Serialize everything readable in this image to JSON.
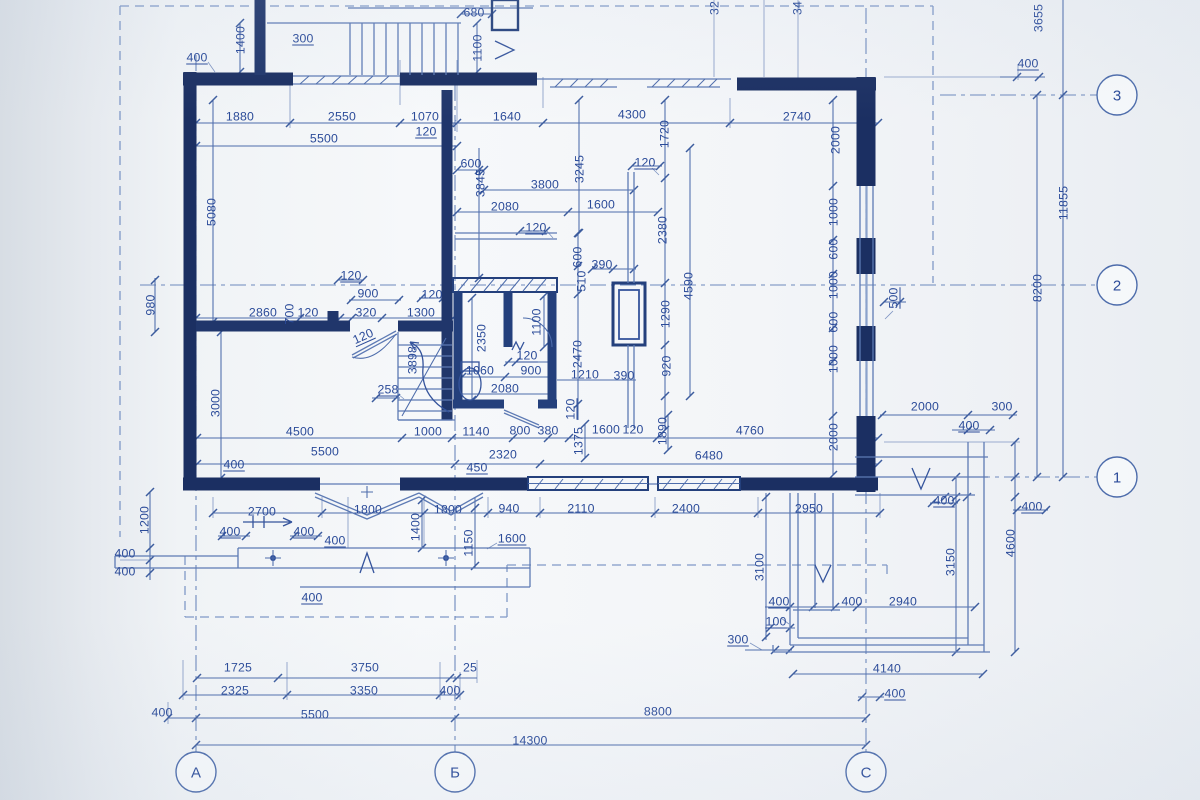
{
  "drawing": {
    "type": "architectural floor plan blueprint",
    "units": "mm"
  },
  "colors": {
    "paper": "#f0f3f6",
    "line_thin": "#4d6cab",
    "wall": "#1b2f62",
    "text": "#2b4b99",
    "dashed": "#8099c7"
  },
  "axis_circles": {
    "radius": 20,
    "bottom": [
      {
        "label": "А",
        "x": 196,
        "y": 772
      },
      {
        "label": "Б",
        "x": 455,
        "y": 772
      },
      {
        "label": "С",
        "x": 866,
        "y": 772
      }
    ],
    "right": [
      {
        "label": "3",
        "x": 1117,
        "y": 95
      },
      {
        "label": "2",
        "x": 1117,
        "y": 285
      },
      {
        "label": "1",
        "x": 1117,
        "y": 477
      }
    ]
  },
  "dimension_labels": [
    [
      "680",
      474,
      12,
      0,
      0
    ],
    [
      "1100",
      477,
      48,
      -90,
      0
    ],
    [
      "400",
      197,
      57,
      0,
      1
    ],
    [
      "1400",
      240,
      40,
      -90,
      0
    ],
    [
      "300",
      303,
      38,
      0,
      1
    ],
    [
      "32",
      714,
      8,
      -90,
      0
    ],
    [
      "34",
      797,
      8,
      -90,
      0
    ],
    [
      "3655",
      1038,
      18,
      -90,
      0
    ],
    [
      "400",
      1028,
      63,
      0,
      1
    ],
    [
      "11855",
      1063,
      203,
      -90,
      0
    ],
    [
      "8200",
      1037,
      288,
      -90,
      0
    ],
    [
      "500",
      893,
      298,
      -90,
      1
    ],
    [
      "1880",
      240,
      116,
      0,
      0
    ],
    [
      "2550",
      342,
      116,
      0,
      0
    ],
    [
      "1070",
      425,
      116,
      0,
      0
    ],
    [
      "120",
      426,
      131,
      0,
      1
    ],
    [
      "1640",
      507,
      116,
      0,
      0
    ],
    [
      "5500",
      324,
      138,
      0,
      0
    ],
    [
      "4300",
      632,
      114,
      0,
      0
    ],
    [
      "2740",
      797,
      116,
      0,
      0
    ],
    [
      "1720",
      664,
      134,
      -90,
      0
    ],
    [
      "2000",
      835,
      140,
      -90,
      0
    ],
    [
      "5080",
      211,
      212,
      -90,
      0
    ],
    [
      "600",
      471,
      163,
      0,
      0
    ],
    [
      "3845",
      480,
      183,
      -90,
      0
    ],
    [
      "3800",
      545,
      184,
      0,
      0
    ],
    [
      "3245",
      579,
      169,
      -90,
      0
    ],
    [
      "2080",
      505,
      206,
      0,
      0
    ],
    [
      "1600",
      601,
      204,
      0,
      0
    ],
    [
      "120",
      536,
      227,
      0,
      1
    ],
    [
      "120",
      645,
      162,
      0,
      1
    ],
    [
      "2380",
      662,
      230,
      -90,
      0
    ],
    [
      "1000",
      833,
      212,
      -90,
      0
    ],
    [
      "600",
      833,
      249,
      -90,
      0
    ],
    [
      "1000",
      833,
      285,
      -90,
      0
    ],
    [
      "600",
      833,
      322,
      -90,
      0
    ],
    [
      "1000",
      833,
      359,
      -90,
      0
    ],
    [
      "2000",
      833,
      437,
      -90,
      0
    ],
    [
      "390",
      602,
      264,
      0,
      0
    ],
    [
      "600",
      577,
      257,
      -90,
      0
    ],
    [
      "510",
      581,
      281,
      -90,
      0
    ],
    [
      "4590",
      688,
      286,
      -90,
      0
    ],
    [
      "1290",
      665,
      314,
      -90,
      0
    ],
    [
      "920",
      666,
      366,
      -90,
      0
    ],
    [
      "2470",
      577,
      354,
      -90,
      0
    ],
    [
      "1210",
      585,
      374,
      0,
      0
    ],
    [
      "390",
      624,
      375,
      0,
      0
    ],
    [
      "120",
      570,
      409,
      -90,
      1
    ],
    [
      "980",
      150,
      305,
      -90,
      0
    ],
    [
      "120",
      351,
      275,
      0,
      1
    ],
    [
      "900",
      368,
      293,
      0,
      0
    ],
    [
      "120",
      432,
      294,
      0,
      0
    ],
    [
      "2860",
      263,
      312,
      0,
      0
    ],
    [
      "700",
      289,
      314,
      -90,
      0
    ],
    [
      "120",
      308,
      312,
      0,
      0
    ],
    [
      "320",
      366,
      312,
      0,
      0
    ],
    [
      "1300",
      421,
      312,
      0,
      0
    ],
    [
      "120",
      363,
      336,
      -24,
      1
    ],
    [
      "3898",
      412,
      360,
      -90,
      0
    ],
    [
      "2350",
      481,
      338,
      -90,
      0
    ],
    [
      "1100",
      536,
      322,
      -90,
      0
    ],
    [
      "120",
      527,
      355,
      0,
      1
    ],
    [
      "900",
      531,
      370,
      0,
      0
    ],
    [
      "1060",
      480,
      370,
      0,
      0
    ],
    [
      "2080",
      505,
      388,
      0,
      0
    ],
    [
      "258",
      388,
      389,
      0,
      1
    ],
    [
      "3000",
      215,
      403,
      -90,
      0
    ],
    [
      "4500",
      300,
      431,
      0,
      0
    ],
    [
      "1000",
      428,
      431,
      0,
      0
    ],
    [
      "1140",
      476,
      431,
      0,
      0
    ],
    [
      "800",
      520,
      430,
      0,
      0
    ],
    [
      "380",
      548,
      430,
      0,
      0
    ],
    [
      "1600",
      606,
      429,
      0,
      0
    ],
    [
      "120",
      633,
      429,
      0,
      0
    ],
    [
      "1375",
      578,
      441,
      -90,
      0
    ],
    [
      "1890",
      662,
      431,
      -90,
      0
    ],
    [
      "4760",
      750,
      430,
      0,
      0
    ],
    [
      "5500",
      325,
      451,
      0,
      0
    ],
    [
      "2320",
      503,
      454,
      0,
      0
    ],
    [
      "6480",
      709,
      455,
      0,
      0
    ],
    [
      "400",
      234,
      464,
      0,
      1
    ],
    [
      "450",
      477,
      467,
      0,
      1
    ],
    [
      "2000",
      925,
      406,
      0,
      0
    ],
    [
      "300",
      1002,
      406,
      0,
      0
    ],
    [
      "400",
      969,
      425,
      0,
      1
    ],
    [
      "400",
      944,
      500,
      0,
      1
    ],
    [
      "400",
      1032,
      506,
      0,
      1
    ],
    [
      "4600",
      1010,
      543,
      -90,
      0
    ],
    [
      "3150",
      950,
      562,
      -90,
      0
    ],
    [
      "3100",
      759,
      567,
      -90,
      0
    ],
    [
      "1200",
      144,
      520,
      -90,
      0
    ],
    [
      "400",
      125,
      553,
      0,
      0
    ],
    [
      "400",
      125,
      571,
      0,
      0
    ],
    [
      "2700",
      262,
      511,
      0,
      0
    ],
    [
      "1800",
      368,
      509,
      0,
      0
    ],
    [
      "1800",
      448,
      509,
      0,
      0
    ],
    [
      "940",
      509,
      508,
      0,
      0
    ],
    [
      "2110",
      581,
      508,
      0,
      0
    ],
    [
      "2400",
      686,
      508,
      0,
      0
    ],
    [
      "2950",
      809,
      508,
      0,
      0
    ],
    [
      "400",
      230,
      531,
      0,
      1
    ],
    [
      "400",
      304,
      531,
      0,
      1
    ],
    [
      "400",
      335,
      540,
      0,
      1
    ],
    [
      "1400",
      415,
      527,
      -90,
      0
    ],
    [
      "1150",
      468,
      543,
      -90,
      0
    ],
    [
      "1600",
      512,
      538,
      0,
      1
    ],
    [
      "400",
      312,
      597,
      0,
      1
    ],
    [
      "400",
      779,
      601,
      0,
      1
    ],
    [
      "100",
      776,
      621,
      0,
      1
    ],
    [
      "300",
      738,
      639,
      0,
      1
    ],
    [
      "400",
      852,
      601,
      0,
      0
    ],
    [
      "2940",
      903,
      601,
      0,
      0
    ],
    [
      "4140",
      887,
      668,
      0,
      0
    ],
    [
      "400",
      895,
      693,
      0,
      1
    ],
    [
      "1725",
      238,
      667,
      0,
      0
    ],
    [
      "3750",
      365,
      667,
      0,
      0
    ],
    [
      "25",
      470,
      667,
      0,
      0
    ],
    [
      "2325",
      235,
      690,
      0,
      0
    ],
    [
      "3350",
      364,
      690,
      0,
      0
    ],
    [
      "400",
      450,
      690,
      0,
      0
    ],
    [
      "400",
      162,
      712,
      0,
      0
    ],
    [
      "5500",
      315,
      714,
      0,
      0
    ],
    [
      "8800",
      658,
      711,
      0,
      0
    ],
    [
      "14300",
      530,
      740,
      0,
      0
    ]
  ]
}
